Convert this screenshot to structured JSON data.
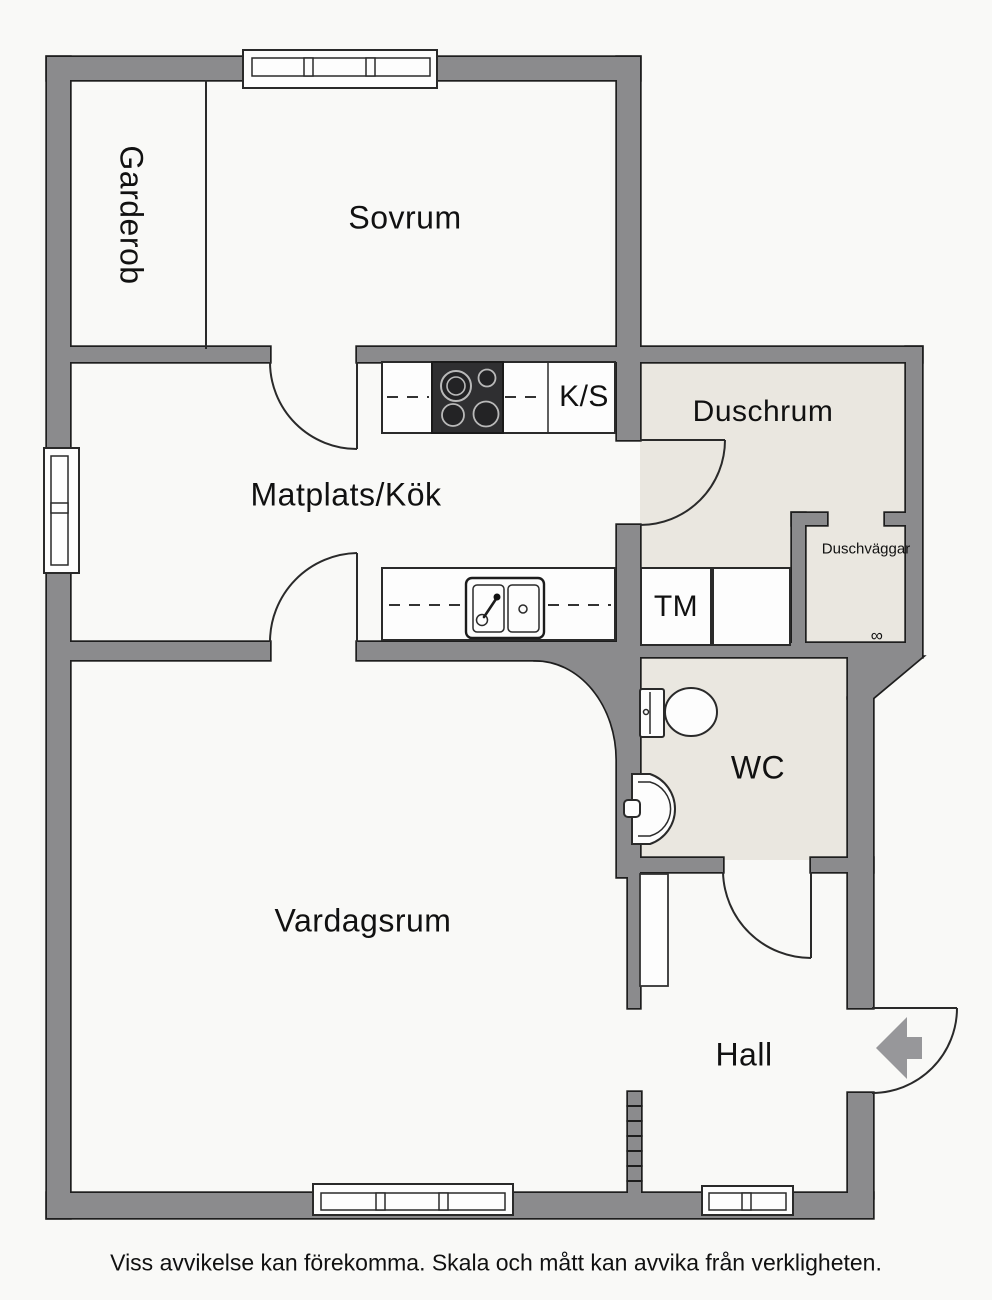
{
  "labels": {
    "garderob": "Garderob",
    "sovrum": "Sovrum",
    "matplats": "Matplats/Kök",
    "ks": "K/S",
    "duschrum": "Duschrum",
    "duschvaggar": "Duschväggar",
    "tm": "TM",
    "wc": "WC",
    "vardagsrum": "Vardagsrum",
    "hall": "Hall"
  },
  "icons": {
    "floor_drain": "∞"
  },
  "disclaimer": "Viss avvikelse kan förekomma. Skala och mått kan avvika från verkligheten.",
  "colors": {
    "wall": "#8b8b8d",
    "wall_outline": "#1e1e1e",
    "wet_floor": "#eae7e0",
    "line": "#2a2a2a",
    "arrow": "#97979a",
    "background": "#f9f9f7",
    "text": "#111111"
  }
}
